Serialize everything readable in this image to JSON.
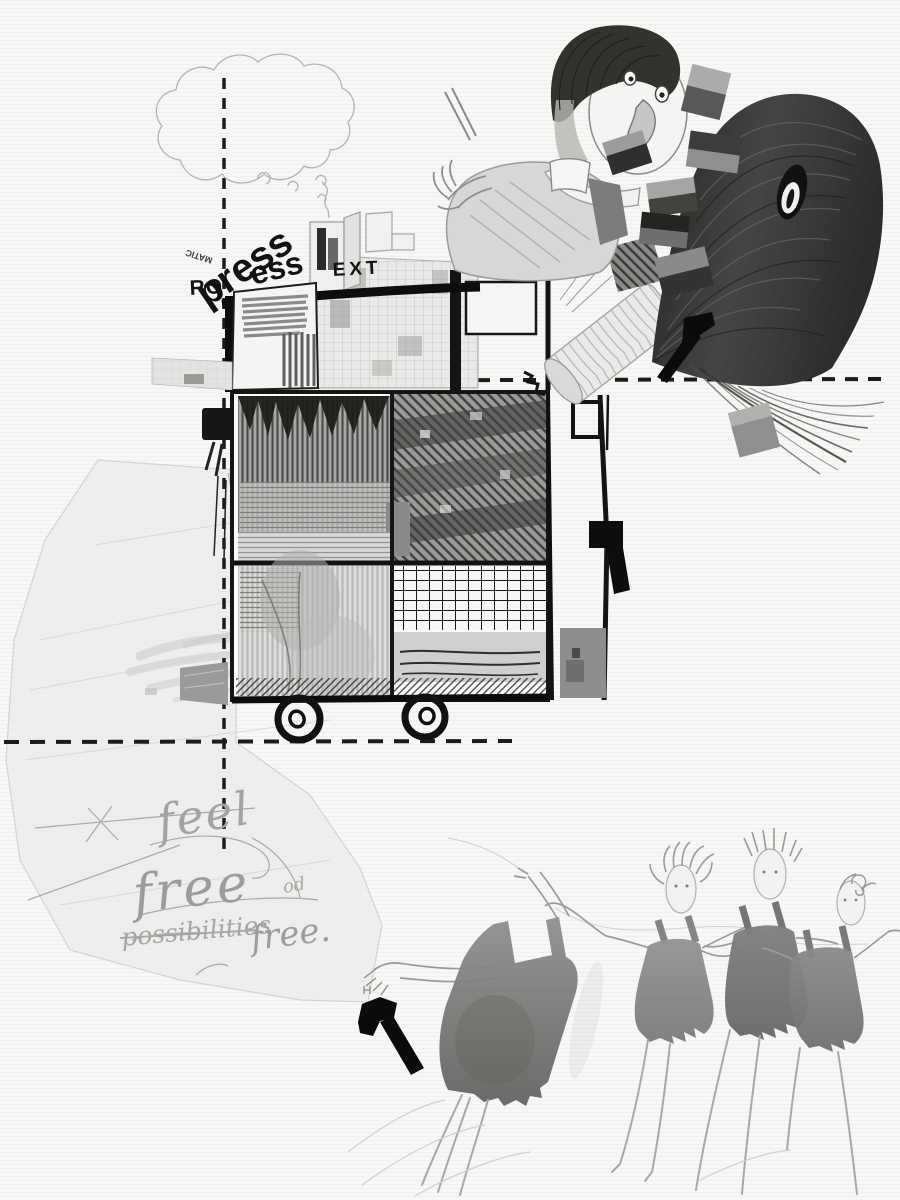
{
  "meta": {
    "description": "Mixed-media collage drawing: a smoking machine-cart on wheels, a boy whose sleeve becomes a striped tube pulling a long-haired head, small collage chips, two black arrows, a piece of tracing paper with handwriting, and four dancing figures in grey wash dresses",
    "canvas_size": "900x1200"
  },
  "palette": {
    "paper": "#f7f7f5",
    "ink": "#141412",
    "pencil": "#9a9a98",
    "graphite_dark": "#3a3a38",
    "wash_grey": "#7f7f7d",
    "tracing_paper": "#ececea"
  },
  "collage_text": {
    "ro": "RO",
    "press": "press",
    "ess": "ess",
    "ext": "EXT",
    "matic": "MATIC"
  },
  "handwriting": {
    "word1": "feel",
    "word2": "free",
    "word3": "possibilities",
    "word4": "free.",
    "word5": "od"
  },
  "icons": {
    "upper_arrow": "arrow-up-right",
    "lower_arrow": "arrow-up-left"
  }
}
